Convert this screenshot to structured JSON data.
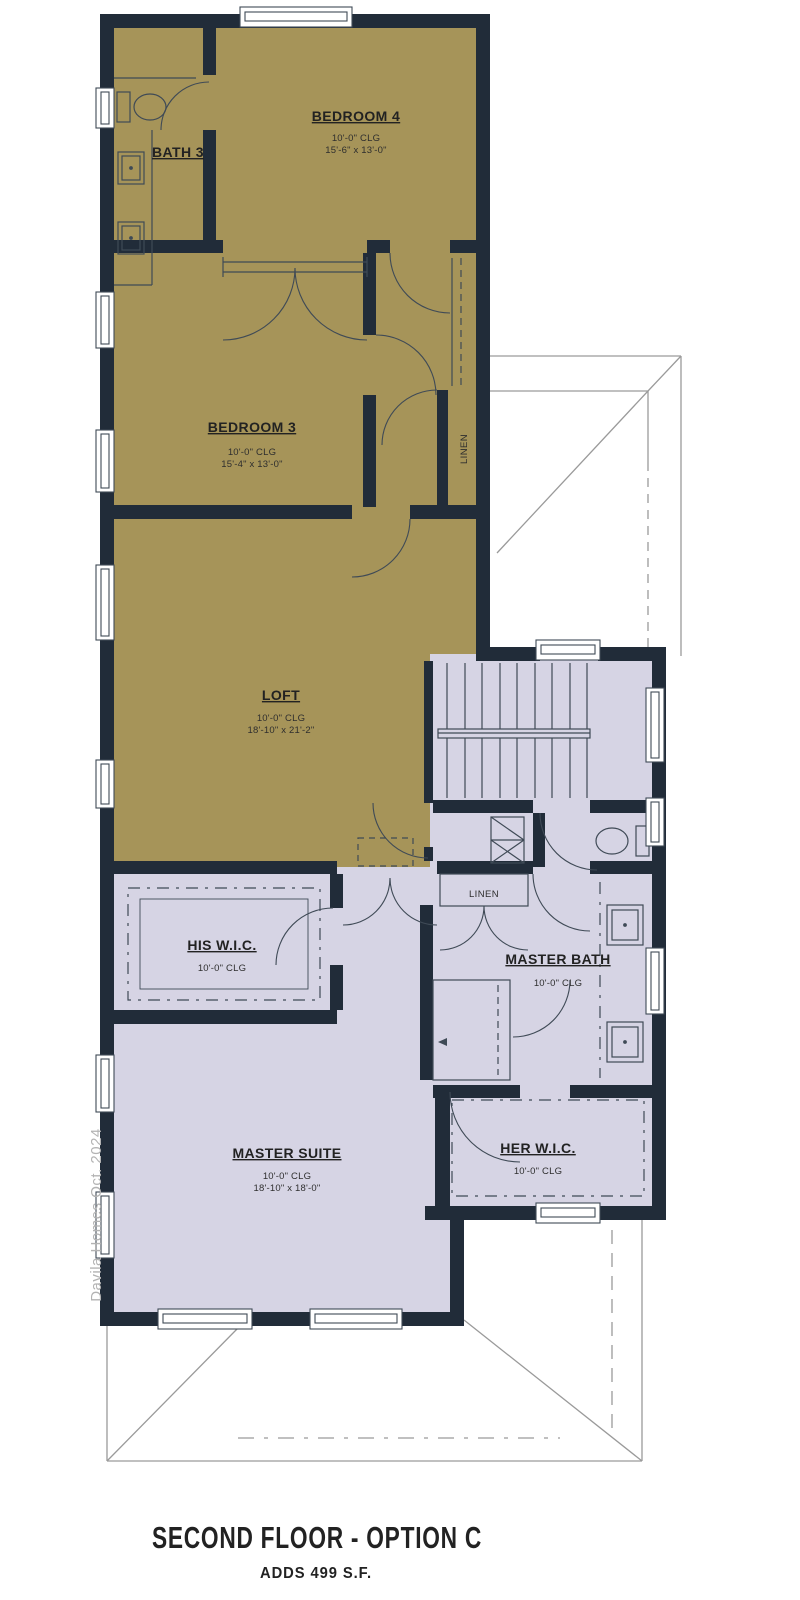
{
  "title": {
    "main": "SECOND FLOOR - OPTION C",
    "subtitle": "ADDS 499 S.F."
  },
  "watermark": "Davila Homes Oct. 2024",
  "rooms": {
    "bath3": {
      "name": "BATH 3"
    },
    "bedroom4": {
      "name": "BEDROOM 4",
      "clg": "10'-0\" CLG",
      "dims": "15'-6\" x 13'-0\""
    },
    "bedroom3": {
      "name": "BEDROOM 3",
      "clg": "10'-0\" CLG",
      "dims": "15'-4\" x 13'-0\""
    },
    "loft": {
      "name": "LOFT",
      "clg": "10'-0\" CLG",
      "dims": "18'-10\" x 21'-2\""
    },
    "his_wic": {
      "name": "HIS W.I.C.",
      "clg": "10'-0\" CLG"
    },
    "master_bath": {
      "name": "MASTER BATH",
      "clg": "10'-0\" CLG"
    },
    "her_wic": {
      "name": "HER W.I.C.",
      "clg": "10'-0\" CLG"
    },
    "master_suite": {
      "name": "MASTER SUITE",
      "clg": "10'-0\" CLG",
      "dims": "18'-10\" x 18'-0\""
    },
    "linen_upper": {
      "name": "LINEN"
    },
    "linen_hall": {
      "name": "LINEN"
    }
  },
  "colors": {
    "walls": "#212c39",
    "option_area": "#a69459",
    "base_area": "#d6d4e4",
    "title_gold": "#a8915a"
  }
}
